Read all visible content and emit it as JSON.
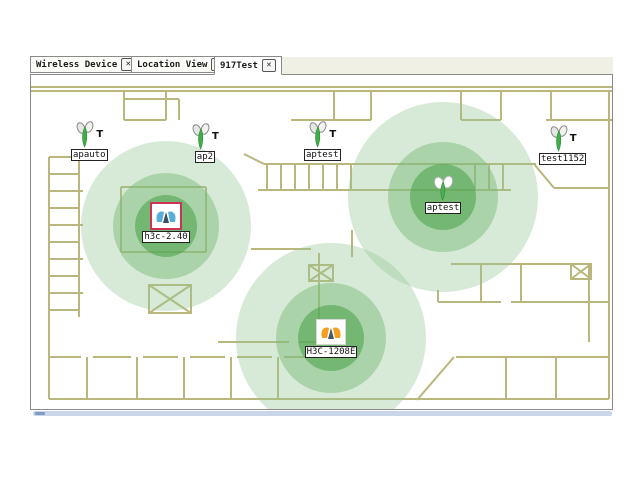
{
  "ui": {
    "close_glyph": "✕"
  },
  "tabs": [
    {
      "label": "Wireless Device",
      "active": false
    },
    {
      "label": "Location View",
      "active": false
    },
    {
      "label": "917Test",
      "active": true
    }
  ],
  "map": {
    "devices_top": [
      {
        "label": "apauto",
        "mark": "T"
      },
      {
        "label": "ap2",
        "mark": "T"
      },
      {
        "label": "aptest",
        "mark": "T"
      },
      {
        "label": "test1152",
        "mark": "T"
      }
    ],
    "devices_coverage": [
      {
        "label": "h3c-2.40",
        "selected": true
      },
      {
        "label": "aptest",
        "selected": false
      },
      {
        "label": "H3C-1208E",
        "selected": false
      }
    ],
    "colors": {
      "wall": "#b9b77b",
      "coverage_outer": "#cfe6cf",
      "coverage_mid": "#9ed29e",
      "coverage_inner": "#63b763",
      "selection_border": "#cc3355"
    }
  }
}
